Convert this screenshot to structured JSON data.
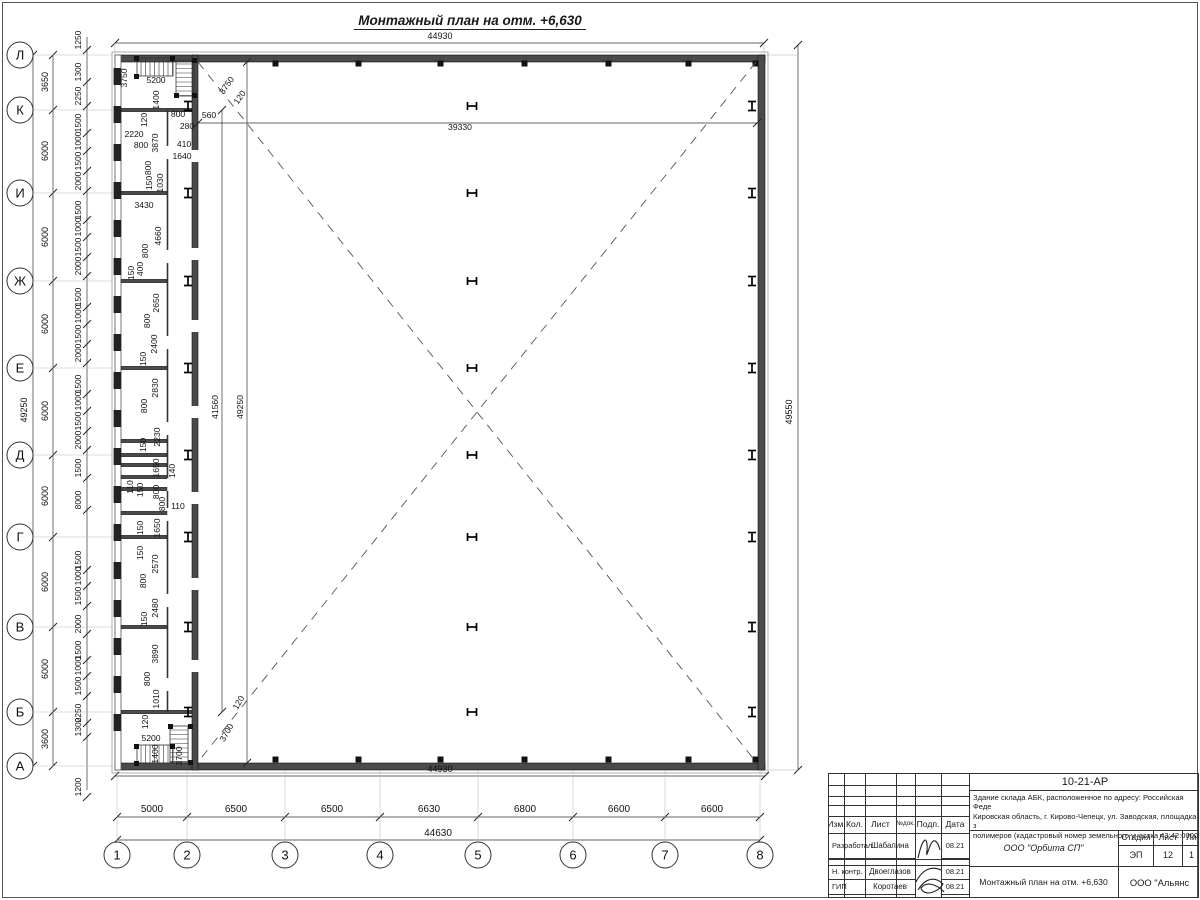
{
  "title": "Монтажный план на отм. +6,630",
  "plan": {
    "column_marker": "Н",
    "overall_top": "44930",
    "overall_bottom_outer": "44930",
    "overall_bottom": "44630",
    "overall_left": "49250",
    "overall_right": "49550",
    "hall_width": "39330",
    "hall_height": "41560",
    "hall_height2": "49250",
    "left_axes": [
      {
        "label": "Л",
        "y": 55
      },
      {
        "label": "К",
        "y": 110
      },
      {
        "label": "И",
        "y": 193
      },
      {
        "label": "Ж",
        "y": 281
      },
      {
        "label": "Е",
        "y": 368
      },
      {
        "label": "Д",
        "y": 455
      },
      {
        "label": "Г",
        "y": 537
      },
      {
        "label": "В",
        "y": 627
      },
      {
        "label": "Б",
        "y": 712
      },
      {
        "label": "А",
        "y": 766
      }
    ],
    "left_spacing": [
      {
        "v": "3650",
        "y": 82
      },
      {
        "v": "6000",
        "y": 151
      },
      {
        "v": "6000",
        "y": 237
      },
      {
        "v": "6000",
        "y": 324
      },
      {
        "v": "6000",
        "y": 411
      },
      {
        "v": "6000",
        "y": 496
      },
      {
        "v": "6000",
        "y": 582
      },
      {
        "v": "6000",
        "y": 669
      },
      {
        "v": "3600",
        "y": 739
      }
    ],
    "left_fine": [
      {
        "v": "1250",
        "y": 40
      },
      {
        "v": "1300",
        "y": 72
      },
      {
        "v": "2250",
        "y": 96
      },
      {
        "v": "1500",
        "y": 123
      },
      {
        "v": "1000",
        "y": 141
      },
      {
        "v": "1500",
        "y": 161
      },
      {
        "v": "2000",
        "y": 181
      },
      {
        "v": "1500",
        "y": 210
      },
      {
        "v": "1000",
        "y": 227
      },
      {
        "v": "1500",
        "y": 247
      },
      {
        "v": "2000",
        "y": 266
      },
      {
        "v": "1500",
        "y": 297
      },
      {
        "v": "1000",
        "y": 314
      },
      {
        "v": "1500",
        "y": 334
      },
      {
        "v": "2000",
        "y": 353
      },
      {
        "v": "1500",
        "y": 384
      },
      {
        "v": "1000",
        "y": 401
      },
      {
        "v": "1500",
        "y": 421
      },
      {
        "v": "2000",
        "y": 440
      },
      {
        "v": "1500",
        "y": 468
      },
      {
        "v": "8000",
        "y": 500
      },
      {
        "v": "1500",
        "y": 560
      },
      {
        "v": "1000",
        "y": 576
      },
      {
        "v": "1500",
        "y": 596
      },
      {
        "v": "2000",
        "y": 624
      },
      {
        "v": "1500",
        "y": 650
      },
      {
        "v": "1000",
        "y": 666
      },
      {
        "v": "1500",
        "y": 686
      },
      {
        "v": "2250",
        "y": 713
      },
      {
        "v": "1300",
        "y": 727
      },
      {
        "v": "1200",
        "y": 787
      }
    ],
    "bottom_axes": [
      {
        "label": "1",
        "x": 117
      },
      {
        "label": "2",
        "x": 187
      },
      {
        "label": "3",
        "x": 285
      },
      {
        "label": "4",
        "x": 380
      },
      {
        "label": "5",
        "x": 478
      },
      {
        "label": "6",
        "x": 573
      },
      {
        "label": "7",
        "x": 665
      },
      {
        "label": "8",
        "x": 760
      }
    ],
    "bottom_spacing": [
      {
        "v": "5000",
        "x": 152
      },
      {
        "v": "6500",
        "x": 236
      },
      {
        "v": "6500",
        "x": 332
      },
      {
        "v": "6630",
        "x": 429
      },
      {
        "v": "6800",
        "x": 525
      },
      {
        "v": "6600",
        "x": 619
      },
      {
        "v": "6600",
        "x": 712
      }
    ],
    "dim_labels": [
      {
        "t": "3750",
        "x": 127,
        "y": 78,
        "r": -90
      },
      {
        "t": "5200",
        "x": 156,
        "y": 83,
        "r": 0
      },
      {
        "t": "1400",
        "x": 159,
        "y": 100,
        "r": -90
      },
      {
        "t": "120",
        "x": 147,
        "y": 120,
        "r": -90
      },
      {
        "t": "800",
        "x": 178,
        "y": 117,
        "r": 0
      },
      {
        "t": "280",
        "x": 187,
        "y": 129,
        "r": 0
      },
      {
        "t": "560",
        "x": 209,
        "y": 118,
        "r": 0
      },
      {
        "t": "2220",
        "x": 134,
        "y": 137,
        "r": 0
      },
      {
        "t": "800",
        "x": 141,
        "y": 148,
        "r": 0
      },
      {
        "t": "3870",
        "x": 158,
        "y": 143,
        "r": -90
      },
      {
        "t": "410",
        "x": 184,
        "y": 147,
        "r": 0
      },
      {
        "t": "1640",
        "x": 182,
        "y": 159,
        "r": 0
      },
      {
        "t": "800",
        "x": 151,
        "y": 168,
        "r": -90
      },
      {
        "t": "3750",
        "x": 229,
        "y": 87,
        "r": -55
      },
      {
        "t": "120",
        "x": 242,
        "y": 99,
        "r": -55
      },
      {
        "t": "150",
        "x": 152,
        "y": 183,
        "r": -90
      },
      {
        "t": "1030",
        "x": 163,
        "y": 183,
        "r": -90
      },
      {
        "t": "3430",
        "x": 144,
        "y": 208,
        "r": 0
      },
      {
        "t": "4660",
        "x": 161,
        "y": 236,
        "r": -90
      },
      {
        "t": "800",
        "x": 148,
        "y": 251,
        "r": -90
      },
      {
        "t": "400",
        "x": 143,
        "y": 269,
        "r": -90
      },
      {
        "t": "150",
        "x": 134,
        "y": 273,
        "r": -90
      },
      {
        "t": "2650",
        "x": 159,
        "y": 303,
        "r": -90
      },
      {
        "t": "800",
        "x": 150,
        "y": 321,
        "r": -90
      },
      {
        "t": "2400",
        "x": 157,
        "y": 344,
        "r": -90
      },
      {
        "t": "150",
        "x": 146,
        "y": 359,
        "r": -90
      },
      {
        "t": "2830",
        "x": 158,
        "y": 388,
        "r": -90
      },
      {
        "t": "800",
        "x": 147,
        "y": 406,
        "r": -90
      },
      {
        "t": "2230",
        "x": 160,
        "y": 437,
        "r": -90
      },
      {
        "t": "150",
        "x": 146,
        "y": 445,
        "r": -90
      },
      {
        "t": "1650",
        "x": 159,
        "y": 468,
        "r": -90
      },
      {
        "t": "140",
        "x": 175,
        "y": 471,
        "r": -90
      },
      {
        "t": "110",
        "x": 133,
        "y": 487,
        "r": -90
      },
      {
        "t": "150",
        "x": 143,
        "y": 490,
        "r": -90
      },
      {
        "t": "800",
        "x": 159,
        "y": 492,
        "r": -90
      },
      {
        "t": "800",
        "x": 165,
        "y": 504,
        "r": -90
      },
      {
        "t": "110",
        "x": 178,
        "y": 509,
        "r": 0
      },
      {
        "t": "150",
        "x": 143,
        "y": 528,
        "r": -90
      },
      {
        "t": "1650",
        "x": 160,
        "y": 528,
        "r": -90
      },
      {
        "t": "150",
        "x": 143,
        "y": 553,
        "r": -90
      },
      {
        "t": "2570",
        "x": 158,
        "y": 564,
        "r": -90
      },
      {
        "t": "800",
        "x": 146,
        "y": 581,
        "r": -90
      },
      {
        "t": "2480",
        "x": 158,
        "y": 608,
        "r": -90
      },
      {
        "t": "150",
        "x": 147,
        "y": 619,
        "r": -90
      },
      {
        "t": "3890",
        "x": 158,
        "y": 654,
        "r": -90
      },
      {
        "t": "800",
        "x": 150,
        "y": 679,
        "r": -90
      },
      {
        "t": "1010",
        "x": 159,
        "y": 699,
        "r": -90
      },
      {
        "t": "120",
        "x": 148,
        "y": 722,
        "r": -90
      },
      {
        "t": "5200",
        "x": 151,
        "y": 741,
        "r": 0
      },
      {
        "t": "1400",
        "x": 158,
        "y": 754,
        "r": -90
      },
      {
        "t": "3700",
        "x": 182,
        "y": 756,
        "r": -90
      },
      {
        "t": "3700",
        "x": 229,
        "y": 734,
        "r": -60
      },
      {
        "t": "120",
        "x": 241,
        "y": 704,
        "r": -60
      },
      {
        "t": "39330",
        "x": 460,
        "y": 130,
        "r": 0
      },
      {
        "t": "41560",
        "x": 218,
        "y": 407,
        "r": -90
      },
      {
        "t": "49250",
        "x": 243,
        "y": 407,
        "r": -90
      }
    ]
  },
  "titleblock": {
    "doc_number": "10-21-АР",
    "description_lines": [
      "Здание склада АБК, расположенное по адресу: Российская Феде",
      "Кировская область, г. Кирово-Чепецк, ул. Заводская, площадка з",
      "полимеров (кадастровый номер земельного участка 43:42:0000"
    ],
    "header_cols": [
      "Изм.",
      "Кол.",
      "Лист",
      "№док.",
      "Подп.",
      "Дата"
    ],
    "rows": [
      {
        "role": "Разработал",
        "name": "Шабалина",
        "date": "08.21"
      },
      {
        "role": "Н. контр.",
        "name": "Двоеглазов",
        "date": "08.21"
      },
      {
        "role": "ГИП",
        "name": "Коротаев",
        "date": "08.21"
      }
    ],
    "org": "ООО \"Орбита СП\"",
    "stage_label": "Стадия",
    "sheet_label": "Лист",
    "sheets_label": "Ли",
    "stage": "ЭП",
    "sheet": "12",
    "sheets": "1",
    "drawing_title": "Монтажный план на отм. +6,630",
    "company": "ООО \"Альянс"
  }
}
